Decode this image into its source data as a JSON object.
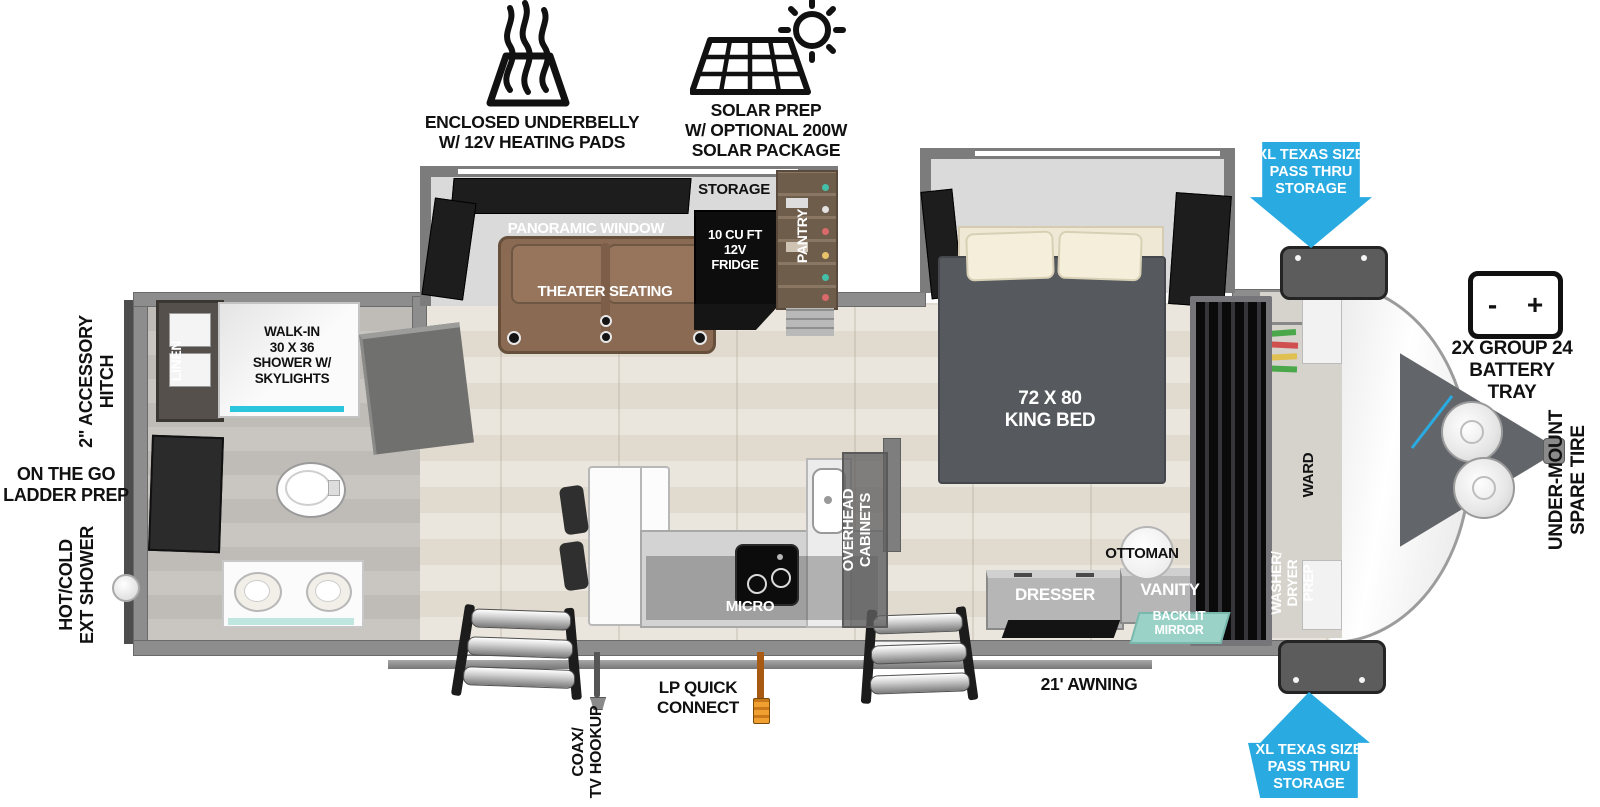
{
  "features": {
    "underbelly": "ENCLOSED UNDERBELLY\nW/ 12V HEATING PADS",
    "solar": "SOLAR PREP\nW/ OPTIONAL 200W\nSOLAR PACKAGE"
  },
  "exterior": {
    "pass_thru_top": "XL TEXAS SIZE\nPASS THRU\nSTORAGE",
    "pass_thru_bottom": "XL TEXAS SIZE\nPASS THRU\nSTORAGE",
    "battery_tray": "2X GROUP 24\nBATTERY\nTRAY",
    "battery_minus": "-",
    "battery_plus": "+",
    "spare_tire": "UNDER-MOUNT\nSPARE TIRE",
    "accessory_hitch": "2\" ACCESSORY\nHITCH",
    "ladder_prep": "ON THE GO\nLADDER PREP",
    "ext_shower": "HOT/COLD\nEXT SHOWER",
    "awning": "21' AWNING",
    "lp_connect": "LP QUICK\nCONNECT",
    "coax": "COAX/\nTV HOOKUP"
  },
  "living": {
    "panoramic_window": "PANORAMIC WINDOW",
    "theater_seating": "THEATER SEATING",
    "storage": "STORAGE",
    "fridge": "10 CU FT\n12V\nFRIDGE",
    "pantry": "PANTRY"
  },
  "kitchen": {
    "micro": "MICRO",
    "overhead_cabinets": "OVERHEAD\nCABINETS"
  },
  "bedroom": {
    "king_bed": "72 X 80\nKING BED",
    "ottoman": "OTTOMAN",
    "dresser": "DRESSER",
    "vanity": "VANITY",
    "backlit_mirror": "BACKLIT\nMIRROR",
    "ward": "WARD",
    "washer_dryer": "WASHER/\nDRYER\nPREP"
  },
  "bath": {
    "linen": "LINEN",
    "shower": "WALK-IN\n30 X 36\nSHOWER W/\nSKYLIGHTS"
  },
  "colors": {
    "arrow_blue": "#29ABE2",
    "mirror_teal": "#9AD2C8",
    "hose_orange": "#E8891B",
    "shower_accent": "#2BC5DE"
  }
}
